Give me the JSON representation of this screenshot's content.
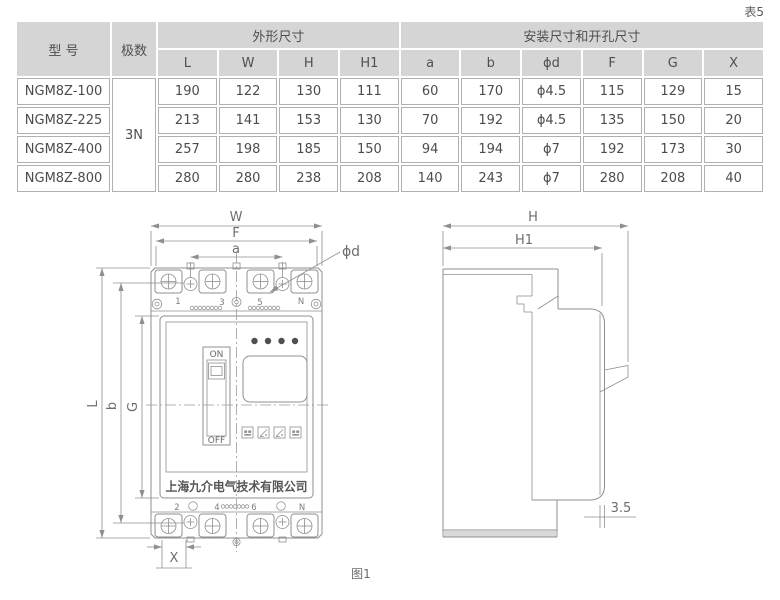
{
  "sheet": {
    "table_tag": "表5",
    "figure_tag": "图1"
  },
  "table": {
    "header": {
      "model": "型 号",
      "poles": "极数",
      "outline_group": "外形尺寸",
      "mount_group": "安装尺寸和开孔尺寸",
      "dims": [
        "L",
        "W",
        "H",
        "H1",
        "a",
        "b",
        "ϕd",
        "F",
        "G",
        "X"
      ]
    },
    "poles_value": "3N",
    "rows": [
      {
        "model": "NGM8Z-100",
        "values": [
          "190",
          "122",
          "130",
          "111",
          "60",
          "170",
          "ϕ4.5",
          "115",
          "129",
          "15"
        ]
      },
      {
        "model": "NGM8Z-225",
        "values": [
          "213",
          "141",
          "153",
          "130",
          "70",
          "192",
          "ϕ4.5",
          "135",
          "150",
          "20"
        ]
      },
      {
        "model": "NGM8Z-400",
        "values": [
          "257",
          "198",
          "185",
          "150",
          "94",
          "194",
          "ϕ7",
          "192",
          "173",
          "30"
        ]
      },
      {
        "model": "NGM8Z-800",
        "values": [
          "280",
          "280",
          "238",
          "208",
          "140",
          "243",
          "ϕ7",
          "280",
          "208",
          "40"
        ]
      }
    ]
  },
  "front_view": {
    "dim_w": "W",
    "dim_f": "F",
    "dim_a": "a",
    "dim_phid": "ϕd",
    "dim_l": "L",
    "dim_b": "b",
    "dim_g": "G",
    "dim_x": "X",
    "top_terminals": [
      "1",
      "3",
      "5",
      "N"
    ],
    "bottom_terminals": [
      "2",
      "4",
      "6",
      "N"
    ],
    "switch_on": "ON",
    "switch_off": "OFF",
    "brand": "上海九介电气技术有限公司"
  },
  "side_view": {
    "dim_h": "H",
    "dim_h1": "H1",
    "dim_offset": "3.5"
  },
  "colors": {
    "header_bg": "#d5d5d5",
    "cell_border": "#b0b0b0",
    "drawing_line": "#8f8f8f",
    "table_text": "#4c4c4c",
    "dim_text": "#6e6e6e"
  }
}
